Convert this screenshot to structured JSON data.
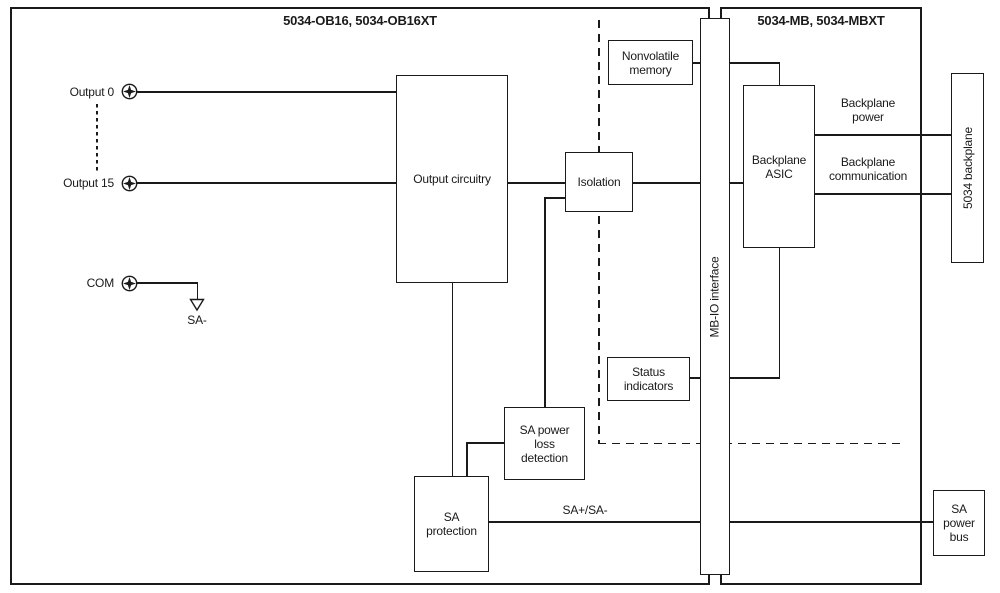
{
  "sections": {
    "module": {
      "title": "5034-OB16, 5034-OB16XT"
    },
    "base": {
      "title": "5034-MB, 5034-MBXT"
    }
  },
  "terminals": {
    "output0": "Output 0",
    "output15": "Output 15",
    "com": "COM"
  },
  "net_labels": {
    "sa_minus": "SA-",
    "sa_plus_sa_minus": "SA+/SA-",
    "backplane_power": "Backplane power",
    "backplane_communication": "Backplane communication"
  },
  "blocks": {
    "output_circuitry": "Output circuitry",
    "isolation": "Isolation",
    "nonvolatile_memory": "Nonvolatile memory",
    "mb_io_interface": "MB-IO interface",
    "backplane_asic": "Backplane ASIC",
    "status_indicators": "Status indicators",
    "sa_power_loss_detection": "SA power loss detection",
    "sa_protection": "SA protection",
    "backplane_5034": "5034 backplane",
    "sa_power_bus": "SA power bus"
  },
  "icons": {
    "screw_terminal": "screw-terminal-icon",
    "ground_arrow": "ground-arrow-icon"
  },
  "colors": {
    "line": "#1a1a1a",
    "background": "#ffffff"
  }
}
